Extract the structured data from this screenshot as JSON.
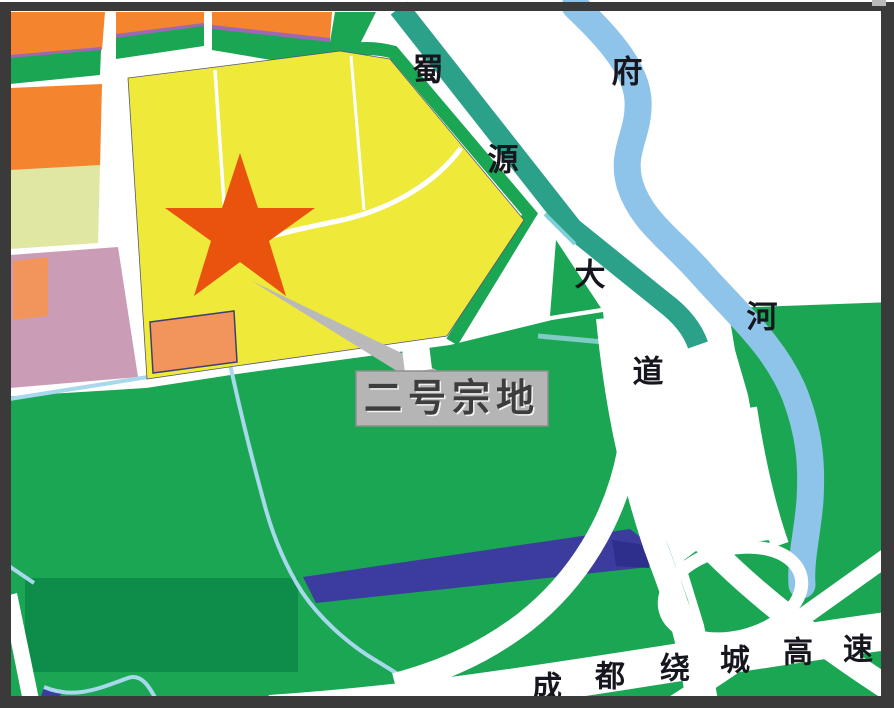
{
  "labels": {
    "plot_callout": "二号宗地",
    "shuyuan_avenue_chars": [
      "蜀",
      "源",
      "大",
      "道"
    ],
    "fu_river_chars": [
      "府",
      "河"
    ],
    "ring_expressway_chars": [
      "成",
      "都",
      "绕",
      "城",
      "高",
      "速"
    ]
  },
  "colors": {
    "star": "#e9530e",
    "yellow_parcel": "#efe93a",
    "orange_parcel": "#f5842e",
    "salmon_parcel": "#f2955c",
    "pink_parcel": "#ca9cb6",
    "pale_green_parcel": "#dfe7a2",
    "green_land": "#1aa653",
    "dark_green_overlay": "#0e8c4a",
    "teal_road": "#2ba189",
    "river_blue": "#8ec4e9",
    "stream_blue": "#a8d8ec",
    "navy_strip": "#3b3c9e",
    "navy_strip_dark": "#2e2f8c",
    "purple_edge": "#9c68b4",
    "callout_gray": "#b9b9b9",
    "label_box_bg": "#b5b5b5",
    "map_text": "#16161e",
    "frame_border": "#3a3a3a",
    "road_white": "#ffffff"
  }
}
